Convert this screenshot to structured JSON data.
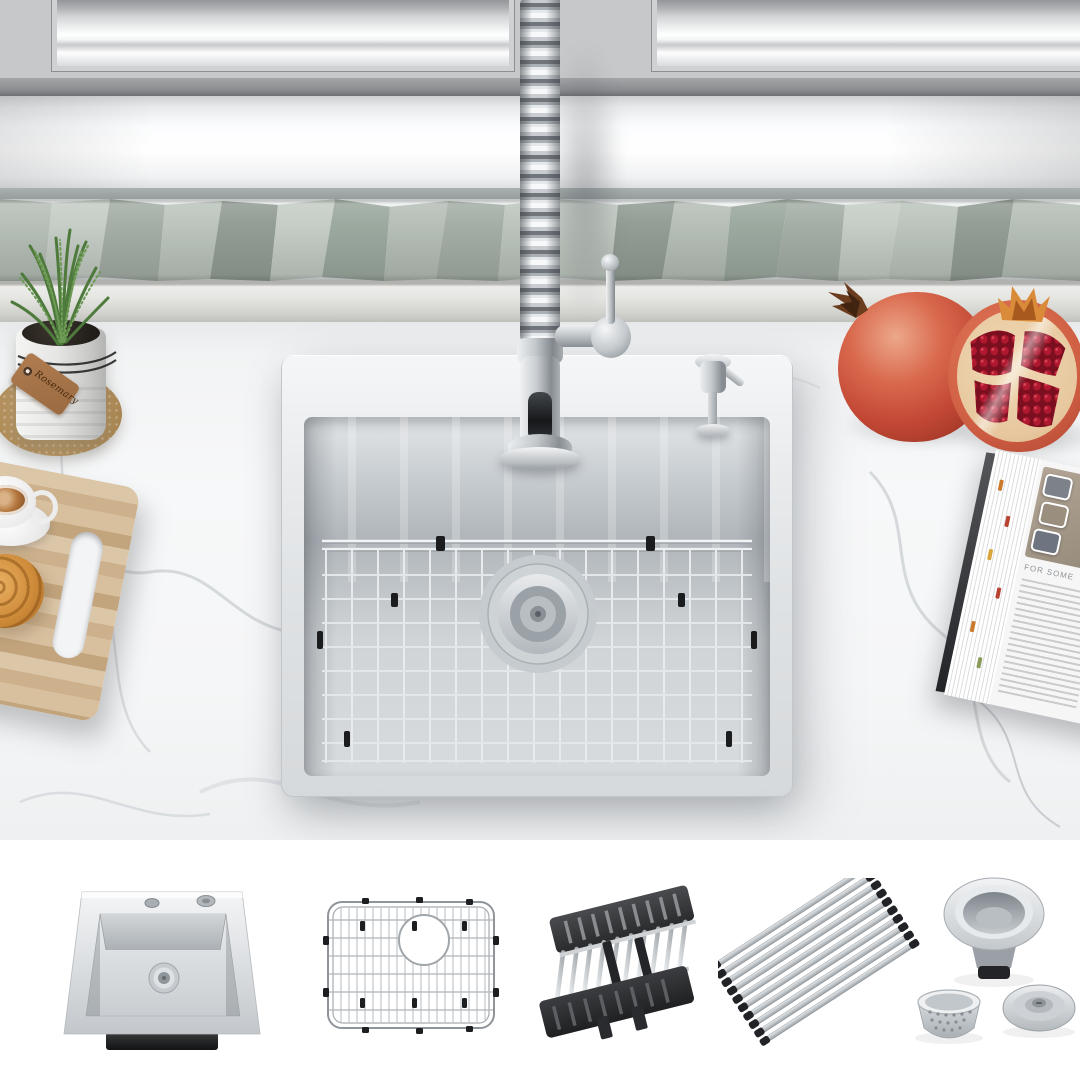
{
  "image": {
    "kind": "product-gallery-photo",
    "subject": "Stainless steel drop-in kitchen sink with spring pull-down faucet",
    "sections": {
      "main_photo": "kitchen-scene",
      "accessory_strip": "included-accessories"
    }
  },
  "scene": {
    "plant_tag_label": "Rosemary",
    "magazine_headline": "FOR SOME"
  },
  "accessories": [
    {
      "name": "drop-in-sink"
    },
    {
      "name": "bottom-grid"
    },
    {
      "name": "expandable-colander-rack"
    },
    {
      "name": "roll-up-drying-rack"
    },
    {
      "name": "drain-strainer-set"
    }
  ],
  "palette": {
    "stainless_light": "#f2f3f4",
    "stainless_mid": "#c7ccd0",
    "stainless_dark": "#878d92",
    "counter_marble": "#f3f4f5",
    "backsplash_tile": "#a8b1aa",
    "cabinet_gray": "#c6c7c9",
    "accent_black": "#232427",
    "pomegranate_red": "#c2503a",
    "aril_red": "#8e1423",
    "wood_tan": "#d4ba97",
    "cork_tan": "#b4935f",
    "rosemary_green": "#4f7a3c"
  }
}
